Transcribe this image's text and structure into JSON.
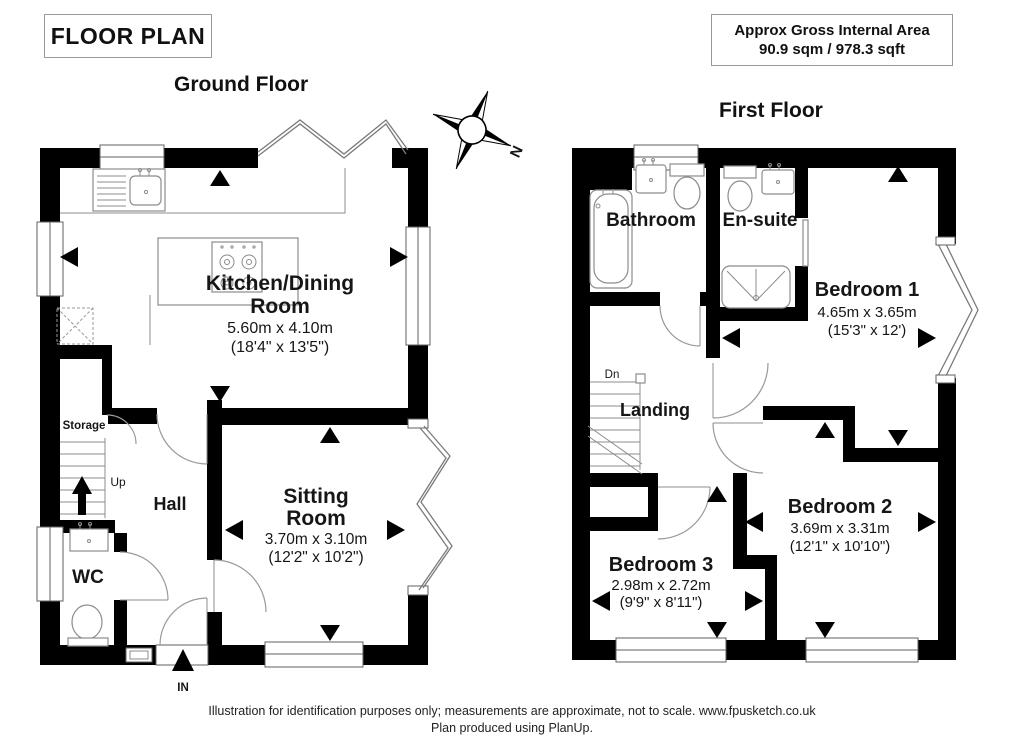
{
  "header": {
    "title": "FLOOR PLAN",
    "area_box": {
      "line1": "Approx Gross Internal Area",
      "line2": "90.9 sqm / 978.3 sqft"
    }
  },
  "compass": {
    "north_label": "N"
  },
  "ground_floor": {
    "heading": "Ground Floor",
    "kitchen": {
      "line1": "Kitchen/Dining",
      "line2": "Room",
      "metric": "5.60m x 4.10m",
      "imperial": "(18'4\" x 13'5\")"
    },
    "sitting": {
      "line1": "Sitting",
      "line2": "Room",
      "metric": "3.70m x 3.10m",
      "imperial": "(12'2\" x 10'2\")"
    },
    "hall": "Hall",
    "wc": "WC",
    "storage": "Storage",
    "up": "Up",
    "entrance": "IN"
  },
  "first_floor": {
    "heading": "First Floor",
    "bathroom": "Bathroom",
    "ensuite": "En-suite",
    "bedroom1": {
      "name": "Bedroom 1",
      "metric": "4.65m x 3.65m",
      "imperial": "(15'3\" x 12')"
    },
    "bedroom2": {
      "name": "Bedroom 2",
      "metric": "3.69m x 3.31m",
      "imperial": "(12'1\" x 10'10\")"
    },
    "bedroom3": {
      "name": "Bedroom 3",
      "metric": "2.98m x 2.72m",
      "imperial": "(9'9\" x 8'11\")"
    },
    "landing": "Landing",
    "down": "Dn"
  },
  "footer": {
    "line1": "Illustration for identification purposes only; measurements are approximate, not to scale. www.fpusketch.co.uk",
    "line2": "Plan produced using PlanUp."
  }
}
